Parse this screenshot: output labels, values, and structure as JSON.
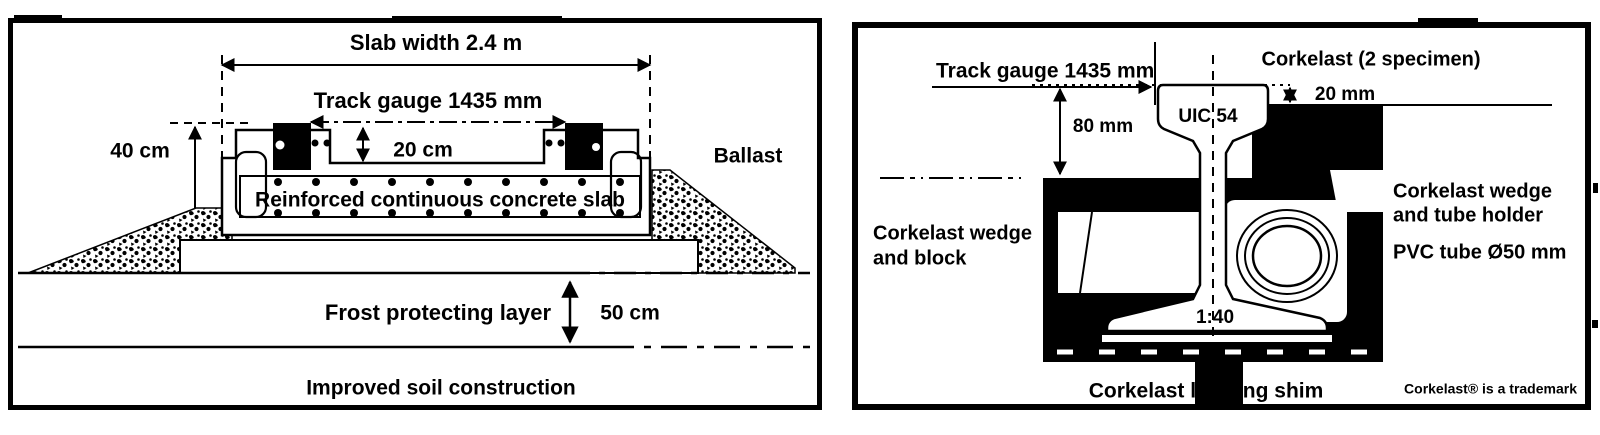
{
  "figure": {
    "left": {
      "slab_width": "Slab width 2.4 m",
      "track_gauge": "Track gauge 1435 mm",
      "dim_40": "40 cm",
      "dim_20": "20 cm",
      "ballast": "Ballast",
      "slab": "Reinforced continuous concrete slab",
      "frost": "Frost protecting layer",
      "dim_50": "50 cm",
      "soil": "Improved soil construction"
    },
    "right": {
      "track_gauge": "Track gauge 1435 mm",
      "specimen": "Corkelast (2 specimen)",
      "dim_20mm": "20 mm",
      "dim_80mm": "80 mm",
      "rail": "UIC 54",
      "wedge_block_1": "Corkelast wedge",
      "wedge_block_2": "and block",
      "wedge_holder_1": "Corkelast wedge",
      "wedge_holder_2": "and tube holder",
      "pvc_tube": "PVC tube Ø50 mm",
      "incline": "1:40",
      "shim": "Corkelast leveling shim",
      "trademark": "Corkelast® is a trademark"
    },
    "colors": {
      "ink": "#000000",
      "paper": "#ffffff"
    }
  }
}
